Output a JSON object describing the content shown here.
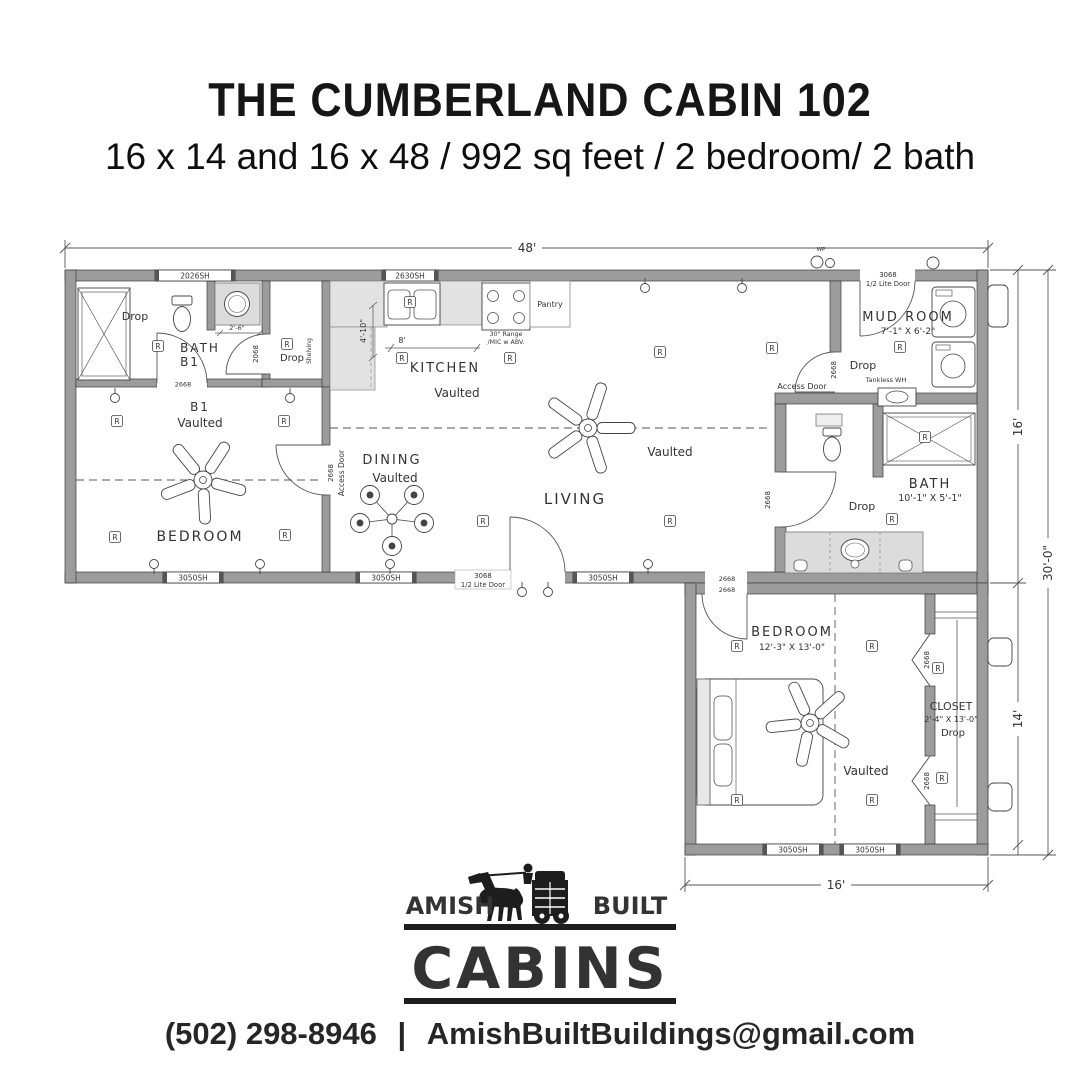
{
  "header": {
    "title": "THE CUMBERLAND CABIN 102",
    "subtitle": "16 x 14 and 16 x 48 / 992 sq feet / 2 bedroom/ 2 bath"
  },
  "plan": {
    "dims": {
      "width_main": "48'",
      "depth_main": "16'",
      "depth_total": "30'-0\"",
      "depth_lower": "14'",
      "width_lower": "16'"
    },
    "labels": {
      "receptacle": "R",
      "drop": "Drop",
      "vaulted": "Vaulted",
      "wp": "WP",
      "access_door": "Access Door",
      "shelving": "Shelving",
      "tankless": "Tankless WH",
      "half_lite": "1/2 Lite Door"
    },
    "windows": {
      "w2026": "2026SH",
      "w2630": "2630SH",
      "w3050": "3050SH"
    },
    "doors": {
      "d3068": "3068",
      "d2668": "2668",
      "d2068": "2068"
    },
    "rooms": {
      "bath_b1": {
        "name": "BATH",
        "sub": "B1",
        "vanity_dim": "2'-6\""
      },
      "bedroom_b1": {
        "sub": "B1",
        "name": "BEDROOM"
      },
      "kitchen": {
        "name": "KITCHEN",
        "range_l1": "30\" Range",
        "range_l2": "/MIC w ABV.",
        "pantry": "Pantry",
        "dim_depth": "4'-10\"",
        "dim_run": "8'"
      },
      "dining": {
        "name": "DINING"
      },
      "living": {
        "name": "LIVING"
      },
      "mud_room": {
        "name": "MUD ROOM",
        "dims": "7'-1\" X 6'-2\""
      },
      "bath": {
        "name": "BATH",
        "dims": "10'-1\" X 5'-1\""
      },
      "bedroom": {
        "name": "BEDROOM",
        "dims": "12'-3\" X 13'-0\""
      },
      "closet": {
        "name": "CLOSET",
        "dims": "2'-4\" X 13'-0\""
      }
    }
  },
  "logo": {
    "amish": "AMISH",
    "built": "BUILT",
    "cabins": "CABINS"
  },
  "footer": {
    "phone": "(502) 298-8946",
    "separator": "|",
    "email": "AmishBuiltBuildings@gmail.com"
  }
}
